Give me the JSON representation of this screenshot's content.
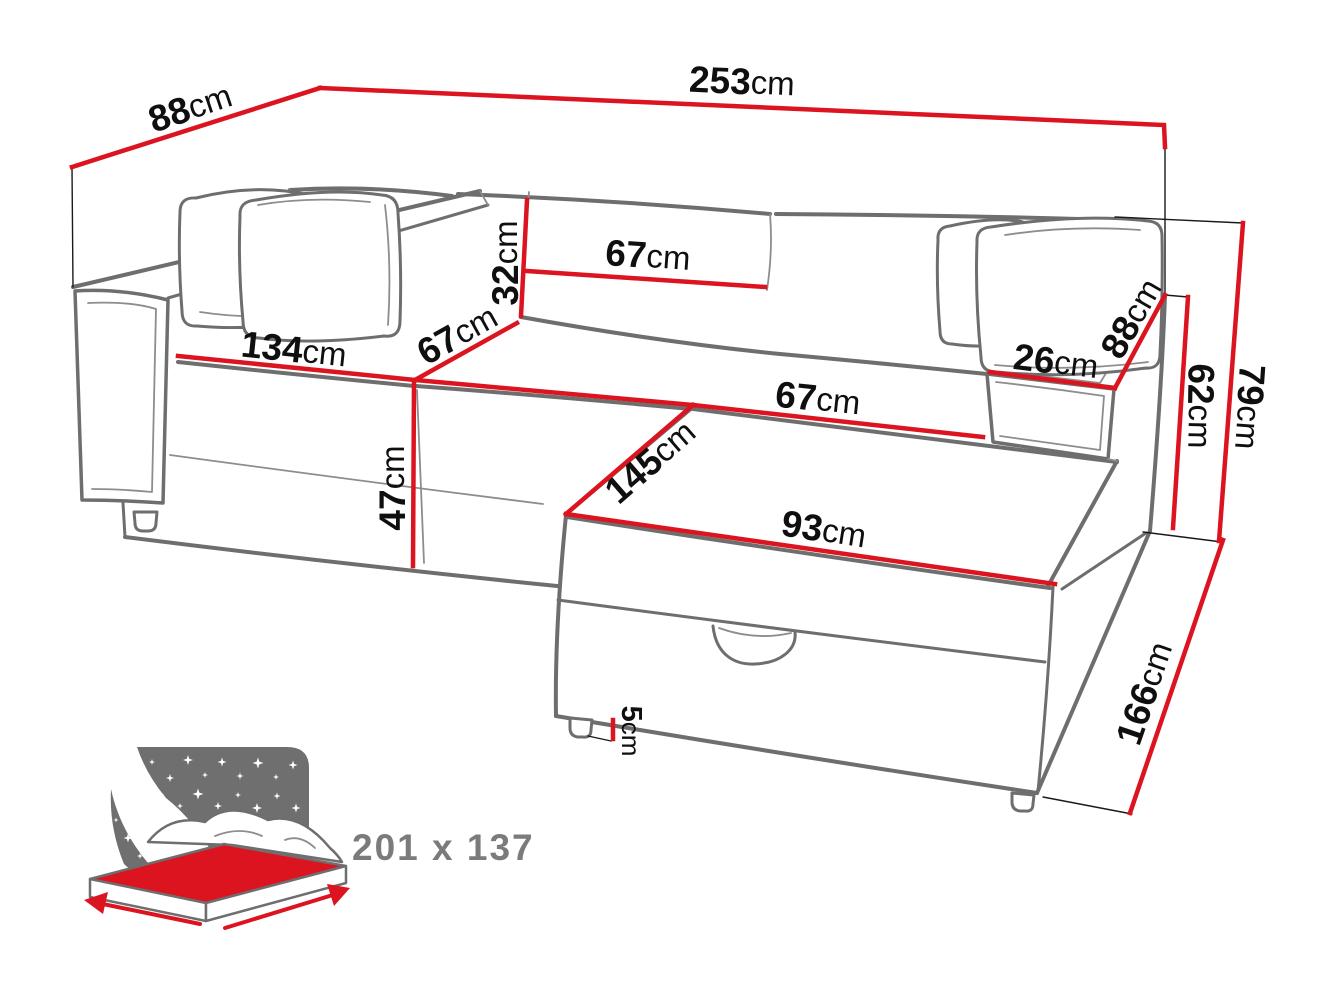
{
  "diagram": {
    "kind": "corner-sofa-bed-dimension-diagram",
    "sleeping_area_label": "201 x 137"
  },
  "colors": {
    "dimension_red": "#dc1420",
    "outline_gray": "#6e6e6e",
    "label_black": "#0f0f0f",
    "icon_gray": "#6f6f6f"
  },
  "dims": {
    "back_width": {
      "value": "253",
      "unit": "cm"
    },
    "back_depth": {
      "value": "88",
      "unit": "cm"
    },
    "backrest_height": {
      "value": "32",
      "unit": "cm"
    },
    "backrest_cushion_width": {
      "value": "67",
      "unit": "cm"
    },
    "left_seat_width": {
      "value": "134",
      "unit": "cm"
    },
    "seat_depth": {
      "value": "67",
      "unit": "cm"
    },
    "seat_height": {
      "value": "47",
      "unit": "cm"
    },
    "chaise_width": {
      "value": "67",
      "unit": "cm"
    },
    "chaise_length": {
      "value": "145",
      "unit": "cm"
    },
    "chaise_front_width": {
      "value": "93",
      "unit": "cm"
    },
    "armrest_width": {
      "value": "26",
      "unit": "cm"
    },
    "armrest_depth": {
      "value": "88",
      "unit": "cm"
    },
    "armrest_height": {
      "value": "62",
      "unit": "cm"
    },
    "total_height": {
      "value": "79",
      "unit": "cm"
    },
    "total_side_depth": {
      "value": "166",
      "unit": "cm"
    },
    "leg_height": {
      "value": "5",
      "unit": "cm"
    }
  }
}
